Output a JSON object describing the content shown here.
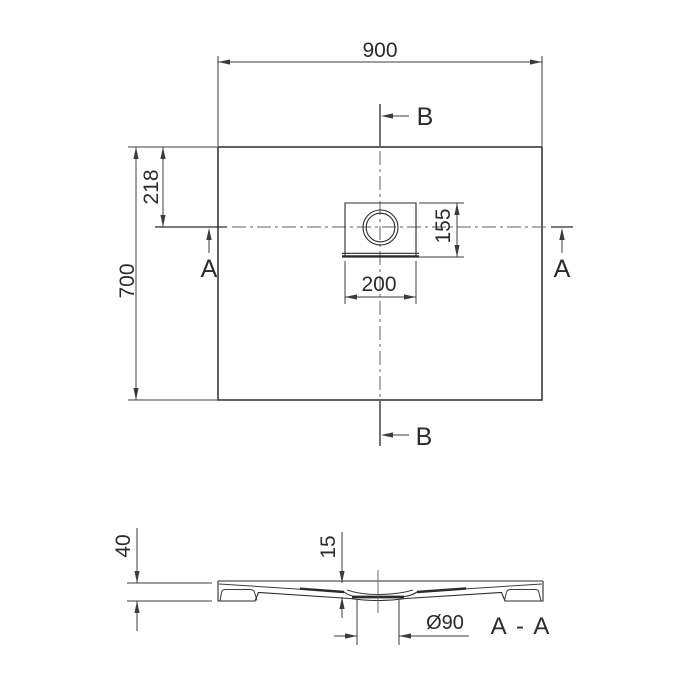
{
  "top_view": {
    "width_dim": "900",
    "height_dim": "700",
    "drain_offset_top_dim": "218",
    "drain_square_width_dim": "200",
    "drain_offset_side_dim": "155",
    "section_a_label_left": "A",
    "section_a_label_right": "A",
    "section_b_label_top": "B",
    "section_b_label_bottom": "B"
  },
  "section_view": {
    "tray_height_dim": "40",
    "drain_recess_depth_dim": "15",
    "drain_diameter_dim": "Ø90",
    "section_title": "A - A"
  },
  "colors": {
    "line": "#2b2b2b",
    "dimension": "#3c3c3c",
    "centerline": "#606060",
    "background": "#ffffff"
  }
}
